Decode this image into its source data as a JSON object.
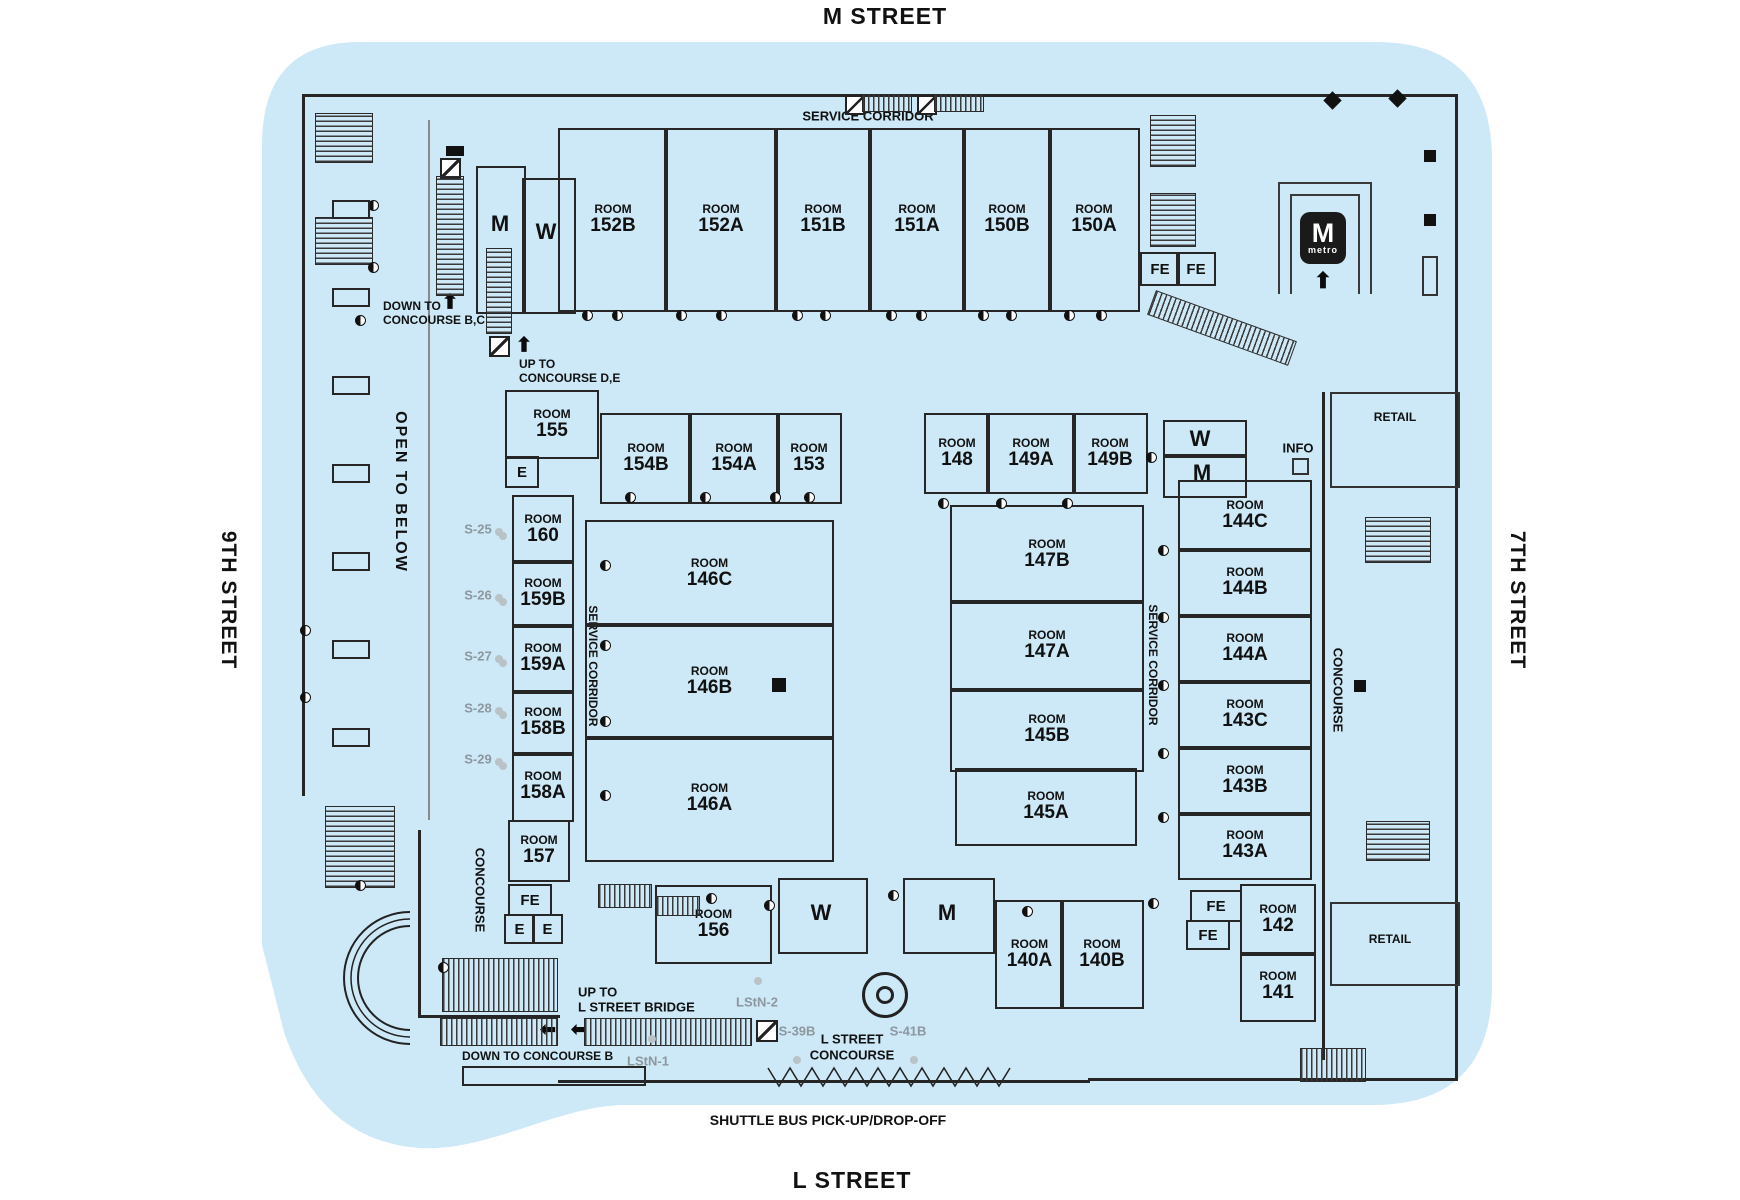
{
  "streets": {
    "top": "M STREET",
    "bottom": "L STREET",
    "left": "9TH STREET",
    "right": "7TH STREET"
  },
  "corridors": {
    "service_top": "SERVICE CORRIDOR",
    "service_left": "SERVICE CORRIDOR",
    "service_right": "SERVICE CORRIDOR",
    "concourse_left": "CONCOURSE",
    "concourse_right": "CONCOURSE",
    "open_to_below": "OPEN TO BELOW",
    "l_street_concourse": [
      "L STREET",
      "CONCOURSE"
    ]
  },
  "directions": {
    "down_bc": [
      "DOWN TO",
      "CONCOURSE B,C"
    ],
    "up_de": [
      "UP TO",
      "CONCOURSE D,E"
    ],
    "up_bridge": [
      "UP TO",
      "L STREET BRIDGE"
    ],
    "down_b": "DOWN TO CONCOURSE B",
    "shuttle": "SHUTTLE BUS PICK-UP/DROP-OFF"
  },
  "room_word": "ROOM",
  "rooms": [
    "152B",
    "152A",
    "151B",
    "151A",
    "150B",
    "150A",
    "155",
    "154B",
    "154A",
    "153",
    "148",
    "149A",
    "149B",
    "160",
    "159B",
    "159A",
    "158B",
    "158A",
    "157",
    "146C",
    "146B",
    "146A",
    "147B",
    "147A",
    "145B",
    "145A",
    "144C",
    "144B",
    "144A",
    "143C",
    "143B",
    "143A",
    "142",
    "141",
    "156",
    "140A",
    "140B"
  ],
  "restrooms": [
    {
      "id": "tl-m",
      "label": "M"
    },
    {
      "id": "tl-w",
      "label": "W"
    },
    {
      "id": "mid-w",
      "label": "W"
    },
    {
      "id": "mid-m",
      "label": "M"
    },
    {
      "id": "bottom-w",
      "label": "W"
    },
    {
      "id": "bottom-m",
      "label": "M"
    }
  ],
  "facilities": [
    {
      "id": "fe-top-1",
      "label": "FE"
    },
    {
      "id": "fe-top-2",
      "label": "FE"
    },
    {
      "id": "e-155",
      "label": "E"
    },
    {
      "id": "fe-left",
      "label": "FE"
    },
    {
      "id": "e-left-1",
      "label": "E"
    },
    {
      "id": "e-left-2",
      "label": "E"
    },
    {
      "id": "fe-right-1",
      "label": "FE"
    },
    {
      "id": "fe-right-2",
      "label": "FE"
    }
  ],
  "stair_codes": [
    "S-25",
    "S-26",
    "S-27",
    "S-28",
    "S-29"
  ],
  "bottom_codes": {
    "lstn1": "LStN-1",
    "lstn2": "LStN-2",
    "s39b": "S-39B",
    "s41b": "S-41B"
  },
  "info_label": "INFO",
  "retail_label": "RETAIL",
  "metro": {
    "m": "M",
    "text": "metro"
  },
  "colors": {
    "building_fill": "#cde8f6",
    "wall": "#262626",
    "grey_text": "#8d979e"
  }
}
